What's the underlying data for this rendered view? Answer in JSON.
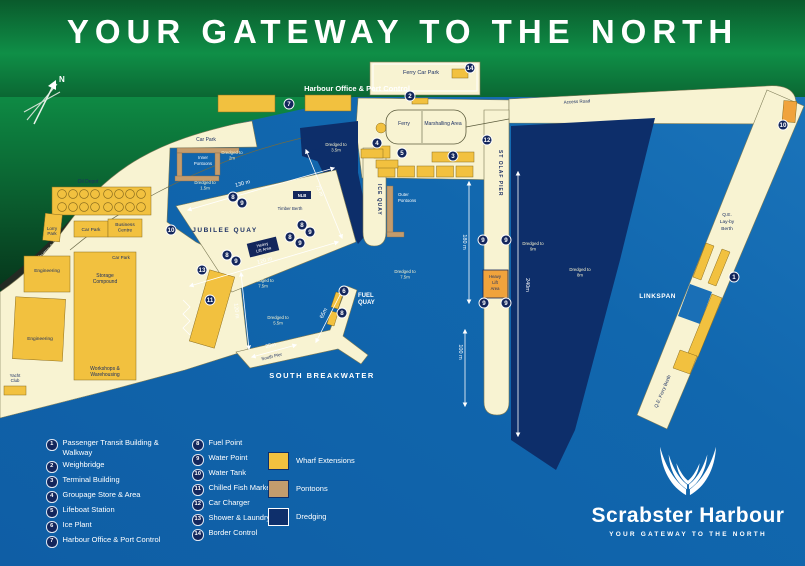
{
  "page": {
    "title": "YOUR GATEWAY TO THE NORTH"
  },
  "map": {
    "colors": {
      "sea": "#0F5EA5",
      "sea_light": "#1D77BD",
      "dredge": "#0D2E6A",
      "land": "#F8F3D2",
      "green": "#0F9048",
      "wharf": "#F2C13F",
      "pontoon": "#C39C6D",
      "orange": "#F0A33C",
      "marker": "#13265C"
    },
    "labels": {
      "north": "N",
      "harbour_office": "Harbour Office & Port Control",
      "ferry_car_park": "Ferry Car Park",
      "ferry": "Ferry",
      "marshalling_area": "Marshalling Area",
      "access_road": "Access Road",
      "car_park_basin": "Car Park",
      "car_park_mid": "Car Park",
      "car_park_storage": "Car Park",
      "business_centre": "Business|Centre",
      "lorry_park": "Lorry|Park",
      "oil_depot": "Oil Depot",
      "engineering_upper": "Engineering",
      "engineering_lower": "Engineering",
      "storage_compound": "Storage|Compound",
      "workshops": "Workshops &|Warehousing",
      "yacht_club": "Yacht|Club",
      "to_thurso": "To Thurso 1 Mile",
      "jubilee_quay": "JUBILEE QUAY",
      "ice_quay": "ICE QUAY",
      "st_olaf_pier": "ST OLAF PIER",
      "fuel_quay": "FUEL|QUAY",
      "south_breakwater": "SOUTH BREAKWATER",
      "south_pier": "South Pier",
      "linkspan": "LINKSPAN",
      "qe_layby": "Q.E.|Lay-by|Berth",
      "qe_ferry_berth": "Q.E. Ferry Berth",
      "inner_pontoons": "Inner|Pontoons",
      "outer_pontoons": "Outer|Pontoons",
      "timber_berth": "Timber Berth",
      "nlb_berth": "NLB",
      "heavy_lift_quay": "Heavy|Lift Area",
      "heavy_lift_pier": "Heavy|Lift|Area"
    },
    "dredged": {
      "d1": "Dredged to|2m",
      "d2": "Dredged to|1.5m",
      "d3": "Dredged to|3.5m",
      "d4": "Dredged to|7.5m",
      "d5": "Dredged to|5.5m",
      "d6": "Dredged to|7.5m",
      "d7": "Dredged to|9m",
      "d8": "Dredged to|8m"
    },
    "measurements": {
      "jubilee_nw": "130 m",
      "timber": "73 m",
      "jubilee_s": "120 m",
      "west_quay": "120 m",
      "breakwater": "25m",
      "fuel": "65m",
      "pier_w": "180 m",
      "pier_e": "240m",
      "pier_s": "100 m"
    },
    "markers": [
      {
        "n": 7,
        "x": 289,
        "y": 104
      },
      {
        "n": 14,
        "x": 470,
        "y": 68
      },
      {
        "n": 2,
        "x": 410,
        "y": 96
      },
      {
        "n": 4,
        "x": 377,
        "y": 143
      },
      {
        "n": 5,
        "x": 402,
        "y": 153
      },
      {
        "n": 3,
        "x": 453,
        "y": 156
      },
      {
        "n": 12,
        "x": 487,
        "y": 140
      },
      {
        "n": 10,
        "x": 783,
        "y": 125
      },
      {
        "n": 10,
        "x": 171,
        "y": 230
      },
      {
        "n": 13,
        "x": 202,
        "y": 270
      },
      {
        "n": 11,
        "x": 210,
        "y": 300
      },
      {
        "n": 8,
        "x": 233,
        "y": 197
      },
      {
        "n": 9,
        "x": 242,
        "y": 203
      },
      {
        "n": 8,
        "x": 302,
        "y": 225
      },
      {
        "n": 9,
        "x": 310,
        "y": 232
      },
      {
        "n": 8,
        "x": 290,
        "y": 237
      },
      {
        "n": 9,
        "x": 300,
        "y": 243
      },
      {
        "n": 8,
        "x": 227,
        "y": 255
      },
      {
        "n": 9,
        "x": 236,
        "y": 261
      },
      {
        "n": 6,
        "x": 344,
        "y": 291
      },
      {
        "n": 8,
        "x": 342,
        "y": 313
      },
      {
        "n": 9,
        "x": 483,
        "y": 240
      },
      {
        "n": 9,
        "x": 506,
        "y": 240
      },
      {
        "n": 9,
        "x": 484,
        "y": 303
      },
      {
        "n": 9,
        "x": 506,
        "y": 303
      },
      {
        "n": 1,
        "x": 734,
        "y": 277
      }
    ]
  },
  "legend": {
    "items": [
      {
        "n": 1,
        "label": "Passenger Transit Building & Walkway"
      },
      {
        "n": 2,
        "label": "Weighbridge"
      },
      {
        "n": 3,
        "label": "Terminal Building"
      },
      {
        "n": 4,
        "label": "Groupage Store & Area"
      },
      {
        "n": 5,
        "label": "Lifeboat Station"
      },
      {
        "n": 6,
        "label": "Ice Plant"
      },
      {
        "n": 7,
        "label": "Harbour Office & Port Control"
      },
      {
        "n": 8,
        "label": "Fuel Point"
      },
      {
        "n": 9,
        "label": "Water Point"
      },
      {
        "n": 10,
        "label": "Water Tank"
      },
      {
        "n": 11,
        "label": "Chilled Fish Market"
      },
      {
        "n": 12,
        "label": "Car Charger"
      },
      {
        "n": 13,
        "label": "Shower & Laundry"
      },
      {
        "n": 14,
        "label": "Border Control"
      }
    ],
    "swatches": [
      {
        "label": "Wharf Extensions",
        "color": "#F2C13F",
        "border": "#0E2F6B"
      },
      {
        "label": "Pontoons",
        "color": "#C39C6D",
        "border": "#0E2F6B"
      },
      {
        "label": "Dredging",
        "color": "#0E2F6B",
        "border": "#FFFFFF"
      }
    ]
  },
  "logo": {
    "brand": "Scrabster Harbour",
    "tagline": "YOUR GATEWAY TO THE NORTH"
  }
}
